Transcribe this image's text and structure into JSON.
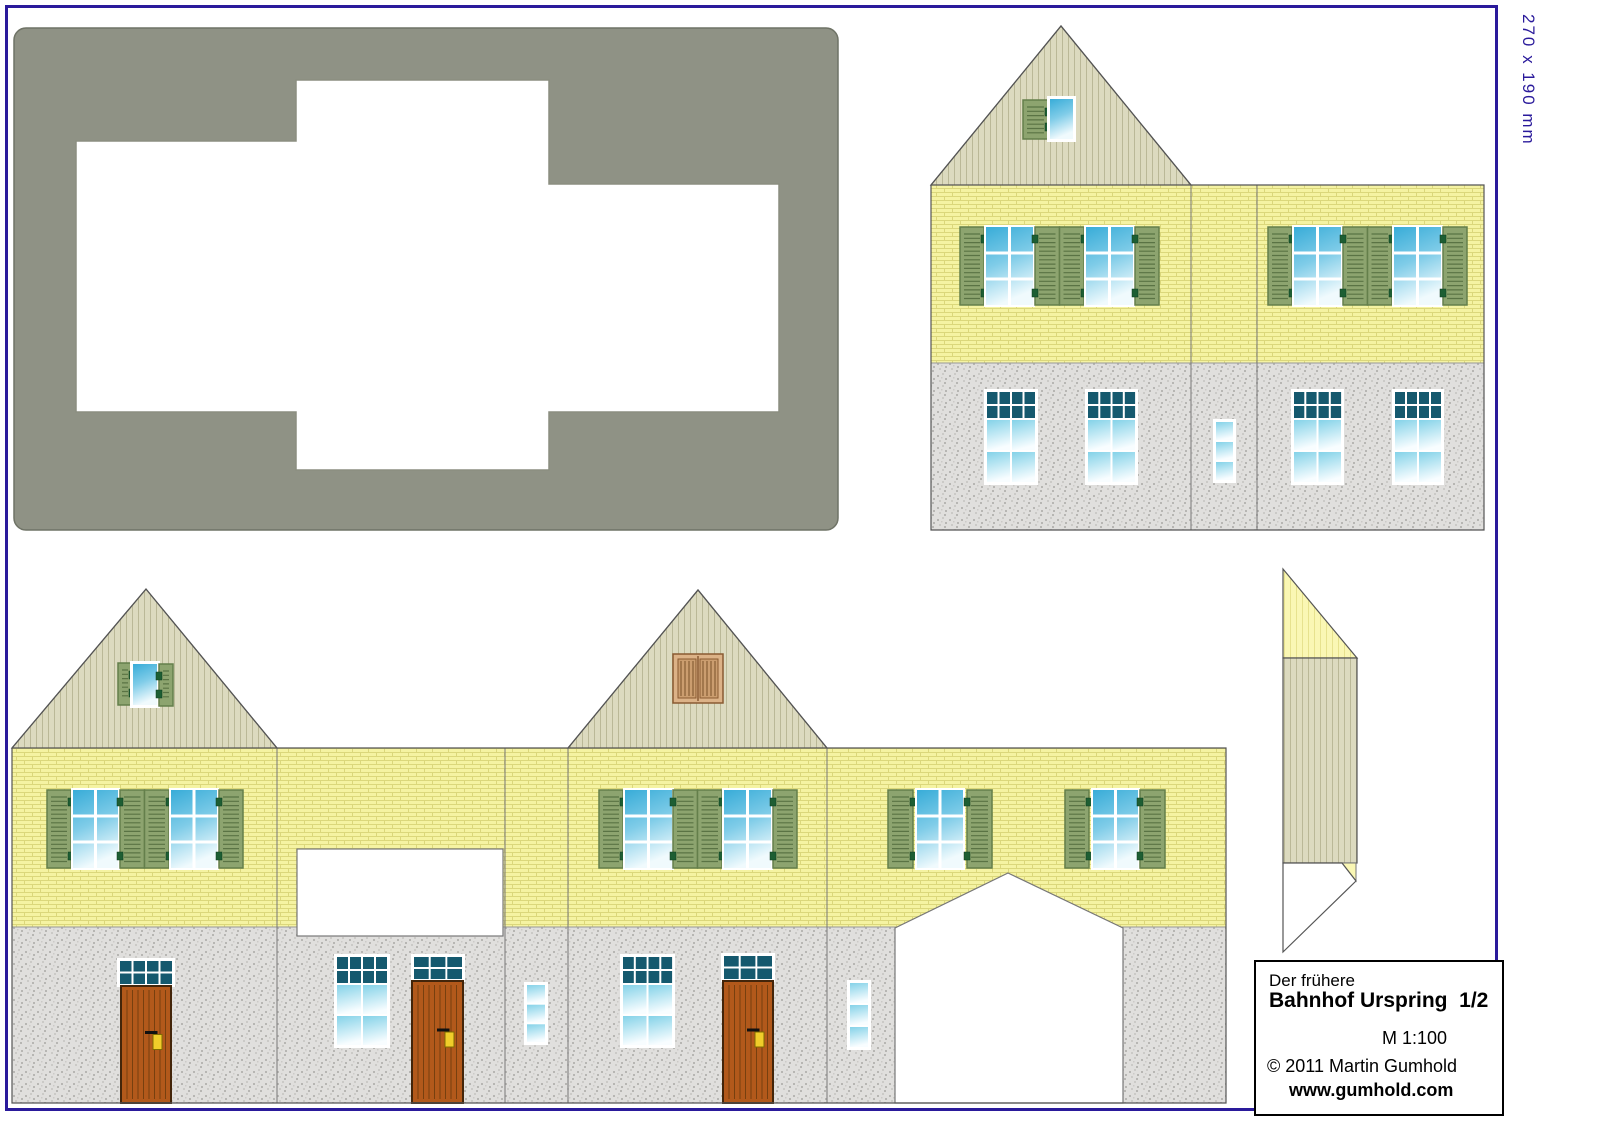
{
  "page": {
    "dimension_label": "270 x 190 mm",
    "border_color": "#2a1a9b",
    "background": "#ffffff"
  },
  "title_block": {
    "subtitle": "Der frühere",
    "title": "Bahnhof Urspring  1/2",
    "scale": "M 1:100",
    "copyright": "© 2011 Martin Gumhold",
    "website": "www.gumhold.com"
  },
  "colors": {
    "page_border": "#2a1a9b",
    "roof_template_gray": "#8f9285",
    "roof_template_edge": "#6f7366",
    "wall_yellow": "#f5f3a2",
    "brick_line": "#dbd77b",
    "stone_gray": "#e0dfdd",
    "stone_dot_dark": "#b7b6b3",
    "stone_dot_light": "#cbcac7",
    "gable_beige": "#dcdabf",
    "gable_stripe": "#bab897",
    "ridge_yellow": "#faf7b4",
    "ridge_stripe": "#e7e28e",
    "shutter_green": "#8da46f",
    "shutter_border": "#647f4b",
    "shutter_slat": "#5a7344",
    "hinge_green": "#1d5e33",
    "window_blue_top": "#38acd8",
    "window_blue_mid": "#7fcce8",
    "window_blue_pale": "#f0fafd",
    "pane_teal": "#15596e",
    "door_brown": "#b2591b",
    "door_line": "#77400f",
    "door_border": "#43250a",
    "handle_gold": "#f0cd2a",
    "vent_frame": "#dcb287",
    "vent_panel": "#cb9d6f",
    "vent_line": "#7a5128",
    "outline": "#555555",
    "cut_line": "#777777"
  }
}
